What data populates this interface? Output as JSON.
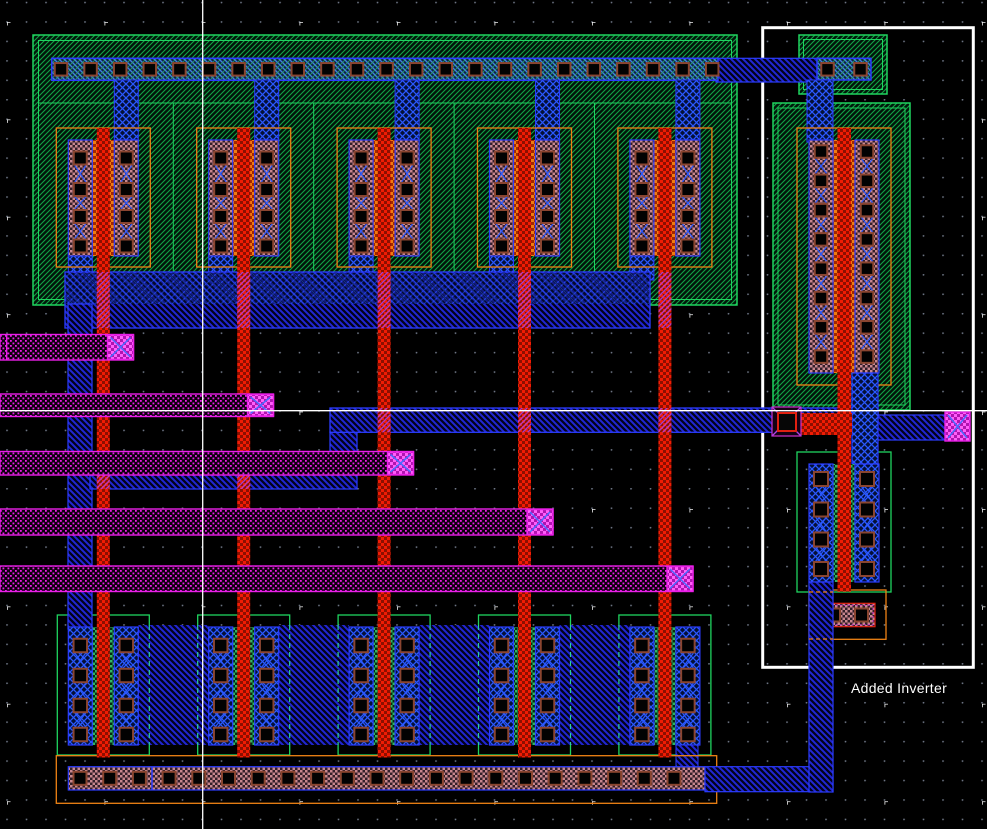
{
  "canvas": {
    "width": 987,
    "height": 829
  },
  "annotation": {
    "label": "Added Inverter"
  },
  "counts": {
    "logic_columns": 5,
    "input_traces": 5,
    "top_rail_contacts": 23,
    "bottom_rail_contacts": 21,
    "pmos_contacts_per_column": 4,
    "nmos_contacts_per_column": 4,
    "inverter_pmos_contacts_per_column": 8,
    "inverter_nmos_contacts_per_column": 4,
    "vdd_stub_contacts": 2,
    "substrate_tap_contacts": 2
  },
  "colors": {
    "background": "#000000",
    "grid_dot": "#6e7685",
    "grid_plus": "#f0f0f0",
    "well_hatch": "#11a345",
    "well_border": "#1fd45f",
    "well_bg": "#02150a",
    "ndiff_a": "#2fb565",
    "ndiff_b": "#052b10",
    "pdiff_a": "#c8868e",
    "pdiff_b": "#331f29",
    "metal1_line": "#2126d4",
    "metal1_bg": "#02021a",
    "metal1_border": "#2b3cff",
    "metal1_bright": "#2a58ff",
    "rail_line": "#3f7de0",
    "rail_bg": "#0d2547",
    "rail_accent": "#2bb163",
    "poly_a": "#f01c04",
    "poly_b": "#8d0f00",
    "gate_a": "#f07c10",
    "gate_b": "#a42600",
    "orange": "#ef8214",
    "contact_border": "#8a4530",
    "metal2": "#ea1fe8",
    "metal2_bg": "#0c000c",
    "via_a": "#ff5ff8",
    "via_b": "#b014b0",
    "via_cross": "#4a6cff",
    "violet": "#b040e0",
    "bridge_dash": "#2fd09a",
    "tap_border": "#e02010",
    "tap_dotted": "#cc33cc",
    "crosshair": "#ffffff",
    "annotation_box": "#ffffff",
    "label_text": "#ffffff"
  }
}
